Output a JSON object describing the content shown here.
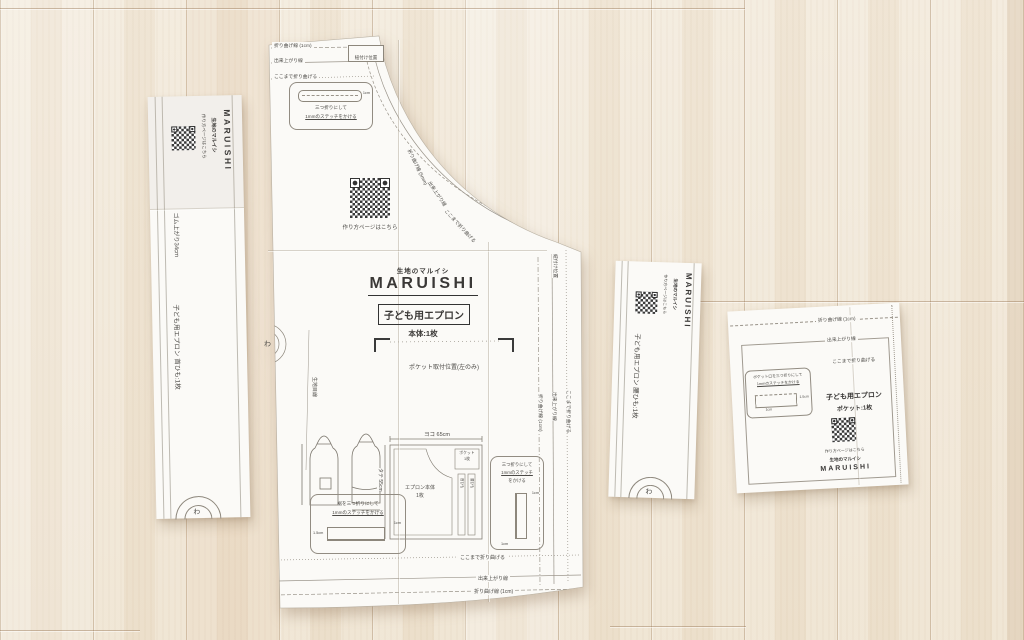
{
  "pieces": {
    "neck_strap": {
      "howto": "作り方ページはこちら",
      "brand_sub": "生地のマルイシ",
      "brand": "MARUISHI",
      "elastic": "ゴム上がり34cm",
      "name": "子ども用エプロン 首ひも:1枚",
      "fold_mark": "わ"
    },
    "waist_strap": {
      "howto": "作り方ページはこちら",
      "brand_sub": "生地のマルイシ",
      "brand": "MARUISHI",
      "name": "子ども用エプロン 腰ひも:1枚",
      "fold_mark": "わ"
    },
    "main": {
      "fold_line_1cm": "折り曲げ線 (1cm)",
      "finish_line": "出来上がり線",
      "fold_here": "ここまで折り曲げる",
      "strap_pos": "紐付け位置",
      "trifold_l1": "三つ折りにして",
      "trifold_l2": "1mmのステッチをかける",
      "dim_1cm": "1cm",
      "dim_15cm": "1.5cm",
      "howto": "作り方ページはこちら",
      "brand_sub": "生地のマルイシ",
      "brand": "MARUISHI",
      "product": "子ども用エプロン",
      "count": "本体:1枚",
      "pocket_pos": "ポケット取付位置(左のみ)",
      "curve_fold": "折り曲げ線 (5mm)",
      "grain": "生地目線",
      "fold_mark": "わ",
      "hem_l1": "裾を三つ折りにして",
      "hem_l2": "1mmのステッチをかける",
      "side_l1": "三つ折りにして",
      "side_l2": "1mmのステッチ",
      "side_l3": "をかける",
      "layout_w": "ヨコ 65cm",
      "layout_h": "タテ 55cm",
      "layout_body_l1": "エプロン本体",
      "layout_body_l2": "1枚",
      "layout_pocket_l1": "ポケット",
      "layout_pocket_l2": "1枚",
      "layout_neck": "首ひも",
      "layout_waist": "腰ひも"
    },
    "pocket": {
      "fold_line_1cm": "折り曲げ線 (1cm)",
      "finish_line": "出来上がり線",
      "fold_here": "ここまで折り曲げる",
      "open_l1": "ポケット口を三つ折りにして",
      "open_l2": "1mmのステッチをかける",
      "dim_15cm": "1.5cm",
      "dim_1cm": "1cm",
      "product": "子ども用エプロン",
      "count": "ポケット:1枚",
      "howto": "作り方ページはこちら",
      "brand_sub": "生地のマルイシ",
      "brand": "MARUISHI"
    }
  }
}
